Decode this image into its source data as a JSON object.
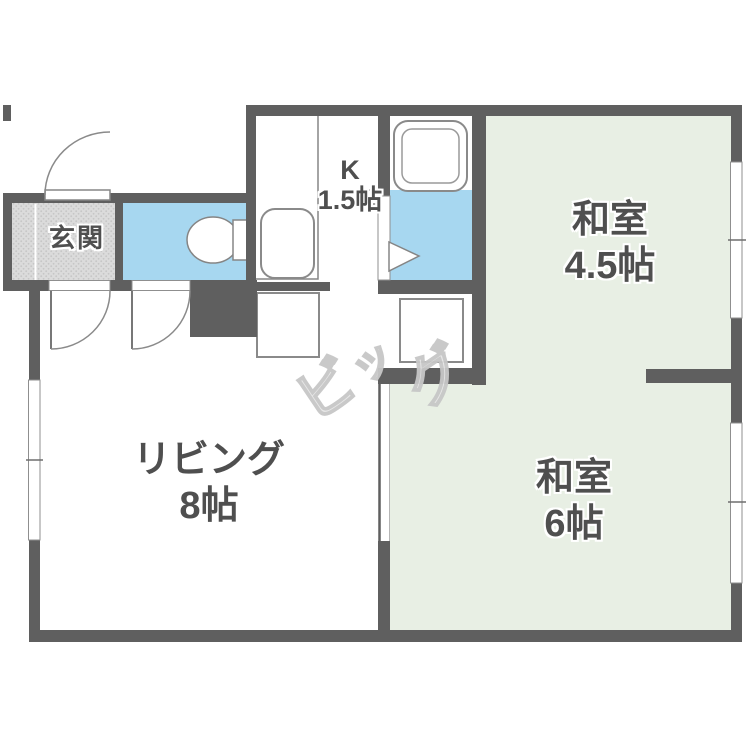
{
  "title": "1LDK apartment floor plan",
  "colors": {
    "wall": "#5f5f5f",
    "tatami": "#e8efe4",
    "water": "#a7d7f0",
    "genkan_bg": "#dbdbdb",
    "genkan_dot": "#c6c6c6",
    "fixture_outline": "#8a8a8a",
    "label_text": "#4f4f4f",
    "watermark": "#e6e6e6",
    "watermark_stroke": "#c7c7c7"
  },
  "rooms": {
    "genkan": {
      "name": "玄関"
    },
    "kitchen": {
      "name": "K",
      "size": "1.5帖"
    },
    "washitsu45": {
      "name": "和室",
      "size": "4.5帖"
    },
    "washitsu6": {
      "name": "和室",
      "size": "6帖"
    },
    "living": {
      "name": "リビング",
      "size": "8帖"
    }
  },
  "watermark": {
    "char1": "ビ",
    "char2": "ッ",
    "char3": "グ"
  },
  "fixtures": {
    "bathtub": "double rounded-rect",
    "toilet": "bowl ellipse with tank",
    "kitchen_sink": "rounded-rect",
    "refrigerator_space": "outlined square",
    "washing_machine_space": "outlined square",
    "entrance_door": "quarter-arc swing",
    "interior_doors": "quarter-arc swings",
    "washroom_door": "triangle marker",
    "windows": "white wall gaps with center tick"
  }
}
